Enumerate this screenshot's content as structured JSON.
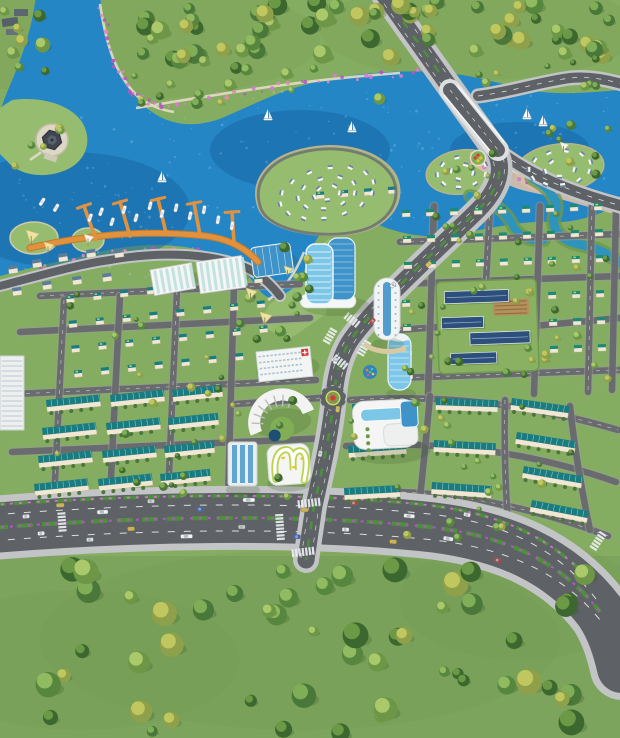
{
  "meta": {
    "title": "aerial-masterplan-render",
    "canvas_width": 620,
    "canvas_height": 738,
    "seed": 11
  },
  "palette": {
    "grass": "#85ad61",
    "grassLight": "#96bd6f",
    "grassDark": "#6e9750",
    "field": "#7ca45d",
    "water": "#2586c6",
    "waterDeep": "#1868a6",
    "canal": "#2f94bb",
    "sparkle": "#cfeaf8",
    "road": "#5e6165",
    "roadMinor": "#696b6f",
    "sidewalk": "#c2c4c5",
    "lane": "#f2f3ee",
    "path": "#e4ddc6",
    "sand": "#dcc0a8",
    "dock": "#e0923e",
    "dockDark": "#c47a2c",
    "roofTeal": "#187c80",
    "roofTeal2": "#1d8a74",
    "roofSlate": "#5d7c9a",
    "roofBlue": "#2c4f7c",
    "lime": "#cadd66",
    "wall": "#f0e8d4",
    "white": "#f5f6f6",
    "glass": "#7cc6e8",
    "glassDark": "#3f93c9",
    "red": "#d63b33",
    "yellow": "#e9c234",
    "sailYellow": "#f0e6a0",
    "sailWhite": "#f8f8f3",
    "flower1": "#b459c0",
    "flower2": "#d77ad2",
    "flower3": "#e08bb0",
    "treePairs": [
      [
        "#3c682f",
        "#6f9c48"
      ],
      [
        "#4a773a",
        "#83b159"
      ],
      [
        "#57863f",
        "#94be63"
      ],
      [
        "#6d9747",
        "#aecb6d"
      ],
      [
        "#8fa04b",
        "#c3c95f"
      ]
    ]
  },
  "water": {
    "main_d": "M36,-4 C30,42 16,70 4,100 L0,112 L0,276 C30,268 54,262 84,256 C118,246 156,241 196,249 C224,255 244,266 258,289 C272,305 287,302 300,281 C308,264 310,250 318,237 C330,217 350,212 372,222 C398,234 428,240 458,234 C492,228 520,221 548,222 C576,224 600,214 622,204 L622,90 C590,92 560,96 530,90 C500,84 470,74 436,72 C396,70 350,73 308,84 C274,93 246,108 222,118 C196,128 172,126 152,112 C128,95 112,62 104,28 L100,-4 Z",
    "deep_spots": [
      [
        70,
        210,
        120,
        58
      ],
      [
        300,
        150,
        90,
        40
      ],
      [
        520,
        150,
        70,
        28
      ]
    ],
    "sparkle_regions": [
      [
        6,
        100,
        220,
        180,
        80
      ],
      [
        240,
        90,
        200,
        140,
        60
      ],
      [
        450,
        92,
        165,
        100,
        45
      ]
    ],
    "canals": [
      {
        "d": "M532,178 C548,186 560,200 555,214 C550,228 560,240 578,244 C598,248 612,256 622,264",
        "w": 9
      },
      {
        "d": "M470,196 C490,200 505,210 512,224 C518,236 530,242 544,240",
        "w": 8
      }
    ]
  },
  "islands": {
    "teardrop": {
      "d": "M258,206 C250,180 268,158 300,150 C340,140 382,150 396,176 C404,194 398,214 376,226 C344,243 266,236 258,206 Z",
      "ring": {
        "cx": 327,
        "cy": 193,
        "rx": 58,
        "ry": 30,
        "rot": -12,
        "rings": [
          [
            0.97,
            14
          ],
          [
            0.6,
            9
          ],
          [
            0.28,
            5
          ]
        ]
      }
    },
    "islets": [
      {
        "cx": 462,
        "cy": 172,
        "rx": 36,
        "ry": 22,
        "rot": -8,
        "rings": [
          [
            0.82,
            9
          ],
          [
            0.4,
            4
          ]
        ]
      },
      {
        "cx": 560,
        "cy": 168,
        "rx": 44,
        "ry": 24,
        "rot": -6,
        "rings": [
          [
            0.84,
            11
          ],
          [
            0.42,
            5
          ]
        ]
      }
    ],
    "gazebo_peninsula": "M12,100 C40,96 70,104 82,122 C92,138 88,158 70,168 C48,180 20,176 8,162 L0,154 L0,108 Z",
    "beach_d": "M470,152 C510,160 540,168 560,178 C585,188 605,196 622,202 L622,216 C590,208 560,198 530,192 C505,187 485,172 470,164 Z",
    "decks": [
      [
        34,
        238,
        24,
        16
      ],
      [
        88,
        240,
        16,
        12
      ]
    ],
    "park_poly": "M270,304 L302,282 L312,252 L330,238 L326,314 L288,340 L258,324 Z"
  },
  "roads": {
    "boulevard": {
      "d": "M-8,528 C140,516 300,514 420,526 C505,534 562,562 600,612 C612,630 618,650 622,668",
      "sw": 64,
      "w": 50
    },
    "boulevard_dashes": [
      "M-8,515 C140,503 300,501 420,513 C505,521 558,549 596,599",
      "M-8,541 C140,529 300,527 424,539 C509,547 566,575 604,625"
    ],
    "boulevard_median": "M-8,528 C140,516 300,514 420,526 C505,534 562,562 600,612",
    "boulevard_north_strip": "M-8,505 C140,494 300,492 418,504 C498,512 548,535 592,582",
    "avenue": {
      "d": "M382,-8 L456,96 L492,146 C506,166 500,188 478,210 C448,240 380,300 352,338 C342,352 336,372 334,396 C331,432 322,470 314,506 L306,560",
      "sw": 26,
      "w": 17
    },
    "avenue_dashes": [
      "M377,-6 L451,98 L487,148 C501,168 495,188 473,210 C443,240 375,300 347,338 C337,352 331,372 329,396 C326,432 317,470 309,506 L301,558",
      "M387,-10 L461,94 L497,144 C511,166 505,188 483,210 C453,240 385,300 357,338 C347,352 341,372 339,396 C336,432 327,470 319,506 L311,560"
    ],
    "others": [
      {
        "name": "north-bank-road",
        "d": "M478,96 C510,92 540,82 570,78 C590,76 608,80 622,84",
        "sw": 15,
        "w": 10,
        "dash": true
      },
      {
        "name": "east-shore-road",
        "d": "M492,146 C530,176 570,192 622,206",
        "sw": 16,
        "w": 11,
        "dash": true
      },
      {
        "name": "west-shore-road",
        "d": "M0,286 C46,274 80,264 110,260 C155,252 205,252 242,266 C258,272 270,283 280,296",
        "sw": 12,
        "w": 8,
        "dash": false
      }
    ],
    "minor": [
      "M40,296 L300,284",
      "M20,332 L310,318",
      "M16,394 L316,380",
      "M12,452 L330,438",
      "M64,300 L54,500",
      "M120,296 L110,498",
      "M177,291 L168,497",
      "M234,287 L228,497",
      "M400,242 L620,234",
      "M398,284 L620,276",
      "M398,330 L440,327",
      "M534,326 L620,318",
      "M396,378 L620,370",
      "M434,206 L428,394",
      "M490,206 L486,282",
      "M540,206 L534,394",
      "M592,206 L588,392",
      "M616,208 L612,390",
      "M350,400 C440,394 530,404 618,430",
      "M346,446 C440,440 532,452 616,482",
      "M342,492 C430,488 520,502 608,536",
      "M430,396 C426,440 422,480 418,516",
      "M505,400 C504,440 505,480 508,524",
      "M570,406 C574,444 580,482 590,530",
      "M320,398 C290,400 262,402 236,404"
    ]
  },
  "bridge": {
    "deck": "M450,90 L498,150",
    "rail1": "M444,95 L491,152",
    "rail2": "M457,85 L504,142"
  },
  "zebras": [
    {
      "x": 352,
      "y": 320,
      "dir": -52,
      "n": 5
    },
    {
      "x": 340,
      "y": 362,
      "dir": -52,
      "n": 5
    },
    {
      "x": 330,
      "y": 336,
      "dir": 30,
      "n": 5
    },
    {
      "x": 364,
      "y": 348,
      "dir": 30,
      "n": 5
    },
    {
      "x": 309,
      "y": 503,
      "dir": 83,
      "n": 7
    },
    {
      "x": 303,
      "y": 552,
      "dir": 83,
      "n": 7
    },
    {
      "x": 280,
      "y": 527,
      "dir": -4,
      "n": 8
    },
    {
      "x": 598,
      "y": 541,
      "dir": 33,
      "n": 6
    },
    {
      "x": 62,
      "y": 522,
      "dir": -4,
      "n": 6
    }
  ],
  "blocks": {
    "villas": [
      {
        "x": 66,
        "y": 296,
        "rows": 4,
        "cols": 8,
        "dx": 27,
        "dy": 25,
        "rot": -6,
        "roof": "#187c80"
      },
      {
        "x": 402,
        "y": 210,
        "rows": 3,
        "cols": 9,
        "dx": 24,
        "dy": 26,
        "rot": -2,
        "roof": "#1d8a74"
      },
      {
        "x": 402,
        "y": 300,
        "rows": 4,
        "cols": 1,
        "dx": 24,
        "dy": 24,
        "rot": -2,
        "roof": "#1d8a74"
      },
      {
        "x": 548,
        "y": 292,
        "rows": 3,
        "cols": 3,
        "dx": 24,
        "dy": 27,
        "rot": -2,
        "roof": "#1d8a74"
      },
      {
        "x": 316,
        "y": 192,
        "rows": 1,
        "cols": 4,
        "dx": 24,
        "dy": 0,
        "rot": -4,
        "roof": "#187c80"
      }
    ],
    "rowhouses": [
      [
        46,
        400,
        54,
        -6
      ],
      [
        110,
        395,
        54,
        -6
      ],
      [
        172,
        390,
        50,
        -6
      ],
      [
        42,
        428,
        54,
        -6
      ],
      [
        106,
        423,
        54,
        -6
      ],
      [
        168,
        418,
        50,
        -6
      ],
      [
        38,
        456,
        54,
        -6
      ],
      [
        102,
        451,
        54,
        -6
      ],
      [
        164,
        446,
        50,
        -6
      ],
      [
        34,
        484,
        54,
        -6
      ],
      [
        98,
        479,
        54,
        -6
      ],
      [
        160,
        474,
        50,
        -6
      ],
      [
        352,
        404,
        58,
        -4
      ],
      [
        348,
        446,
        58,
        -4
      ],
      [
        344,
        488,
        56,
        -3
      ],
      [
        436,
        398,
        62,
        2
      ],
      [
        434,
        440,
        62,
        3
      ],
      [
        432,
        482,
        60,
        4
      ],
      [
        512,
        398,
        58,
        8
      ],
      [
        517,
        432,
        60,
        9
      ],
      [
        524,
        466,
        60,
        10
      ],
      [
        532,
        500,
        58,
        11
      ]
    ],
    "shore_villas": [
      [
        8,
        266
      ],
      [
        32,
        260
      ],
      [
        58,
        254
      ],
      [
        86,
        250
      ],
      [
        114,
        250
      ],
      [
        12,
        288
      ],
      [
        42,
        282
      ],
      [
        72,
        277
      ],
      [
        102,
        274
      ]
    ]
  },
  "marina": {
    "promenade": "M30,248 C90,234 150,230 206,236 C228,239 246,248 258,262",
    "piers": [
      [
        96,
        240,
        84,
        206
      ],
      [
        130,
        236,
        120,
        202
      ],
      [
        166,
        233,
        158,
        199
      ],
      [
        200,
        235,
        194,
        203
      ],
      [
        234,
        243,
        232,
        212
      ]
    ],
    "boats": [
      [
        90,
        218,
        -70
      ],
      [
        101,
        212,
        -70
      ],
      [
        112,
        222,
        -72
      ],
      [
        124,
        210,
        -74
      ],
      [
        136,
        218,
        -74
      ],
      [
        150,
        206,
        -76
      ],
      [
        162,
        214,
        -76
      ],
      [
        176,
        208,
        -78
      ],
      [
        190,
        216,
        -78
      ],
      [
        204,
        210,
        -80
      ],
      [
        218,
        220,
        -80
      ],
      [
        232,
        226,
        -82
      ],
      [
        56,
        208,
        -60
      ],
      [
        42,
        202,
        -58
      ]
    ]
  },
  "sailboats": [
    [
      162,
      180
    ],
    [
      268,
      118
    ],
    [
      352,
      130
    ],
    [
      527,
      117
    ],
    [
      543,
      124
    ]
  ],
  "canopies": [
    {
      "x": 26,
      "y": 230,
      "s": 13,
      "c": "yellow"
    },
    {
      "x": 44,
      "y": 242,
      "s": 10,
      "c": "yellow"
    },
    {
      "x": 84,
      "y": 234,
      "s": 10,
      "c": "white"
    },
    {
      "x": 246,
      "y": 288,
      "s": 11,
      "c": "yellow"
    },
    {
      "x": 260,
      "y": 312,
      "s": 12,
      "c": "yellow"
    },
    {
      "x": 284,
      "y": 266,
      "s": 9,
      "c": "yellow"
    },
    {
      "x": 560,
      "y": 142,
      "s": 9,
      "c": "white"
    }
  ],
  "market_halls": [
    [
      150,
      270,
      42,
      26,
      -10
    ],
    [
      196,
      262,
      46,
      32,
      -8
    ]
  ],
  "landmarks": {
    "gazebo": {
      "x": 52,
      "y": 140
    },
    "twin_tower": {
      "x": 306,
      "y": 238
    },
    "glass_low": {
      "x": 250,
      "y": 248,
      "w": 40,
      "h": 30,
      "rot": -8
    },
    "cylinder_tower": {
      "x": 388,
      "y": 334
    },
    "white_tower": {
      "x": 374,
      "y": 278
    },
    "slab_red_cross": {
      "x": 256,
      "y": 352,
      "w": 54,
      "h": 30,
      "rot": -6
    },
    "fan_building": {
      "x": 248,
      "y": 392
    },
    "track_building": {
      "x": 266,
      "y": 438
    },
    "office_tower2": {
      "x": 228,
      "y": 442
    },
    "mall": {
      "x": 352,
      "y": 402
    },
    "campus": {
      "x": 436,
      "y": 282,
      "w": 100,
      "h": 92,
      "rot": -2,
      "slabs": [
        [
          8,
          10,
          64,
          12
        ],
        [
          4,
          36,
          42,
          11
        ],
        [
          32,
          52,
          60,
          12
        ],
        [
          12,
          72,
          46,
          11
        ]
      ],
      "garden": [
        56,
        20,
        36,
        16
      ]
    },
    "apartment_left": {
      "x": 0,
      "y": 356
    },
    "courts": [
      [
        30,
        386,
        24,
        13
      ],
      [
        33,
        403,
        24,
        13
      ]
    ],
    "temple": {
      "x": 2,
      "y": 8
    },
    "playground": {
      "x": 370,
      "y": 372
    },
    "parterre": {
      "x": 478,
      "y": 158
    },
    "roundabout": {
      "x": 333,
      "y": 398
    }
  },
  "tree_regions": [
    {
      "x": 140,
      "y": 2,
      "w": 240,
      "h": 60,
      "count": 34,
      "rmin": 5,
      "rmax": 10
    },
    {
      "x": 390,
      "y": 2,
      "w": 228,
      "h": 56,
      "count": 30,
      "rmin": 5,
      "rmax": 10
    },
    {
      "x": 0,
      "y": 0,
      "w": 58,
      "h": 78,
      "count": 8,
      "rmin": 4,
      "rmax": 8
    },
    {
      "x": 130,
      "y": 62,
      "w": 250,
      "h": 44,
      "count": 15,
      "rmin": 3,
      "rmax": 6
    },
    {
      "x": 470,
      "y": 56,
      "w": 148,
      "h": 32,
      "count": 9,
      "rmin": 3,
      "rmax": 5
    },
    {
      "x": 0,
      "y": 566,
      "w": 618,
      "h": 168,
      "count": 52,
      "rmin": 5,
      "rmax": 13
    },
    {
      "x": 55,
      "y": 292,
      "w": 250,
      "h": 205,
      "count": 32,
      "rmin": 2.5,
      "rmax": 4.5
    },
    {
      "x": 398,
      "y": 206,
      "w": 218,
      "h": 185,
      "count": 38,
      "rmin": 2.5,
      "rmax": 4.5
    },
    {
      "x": 344,
      "y": 398,
      "w": 262,
      "h": 140,
      "count": 24,
      "rmin": 2.5,
      "rmax": 4.5
    },
    {
      "x": 240,
      "y": 246,
      "w": 85,
      "h": 92,
      "count": 11,
      "rmin": 3,
      "rmax": 5.5
    },
    {
      "x": 540,
      "y": 122,
      "w": 76,
      "h": 55,
      "count": 8,
      "rmin": 3,
      "rmax": 5
    },
    {
      "x": 432,
      "y": 150,
      "w": 80,
      "h": 48,
      "count": 6,
      "rmin": 2.5,
      "rmax": 4
    },
    {
      "x": 8,
      "y": 104,
      "w": 70,
      "h": 62,
      "count": 5,
      "rmin": 3,
      "rmax": 5
    }
  ],
  "flower_lines": [
    {
      "pts": [
        [
          101,
          8
        ],
        [
          112,
          60
        ],
        [
          130,
          92
        ],
        [
          158,
          108
        ]
      ],
      "count": 26
    },
    {
      "pts": [
        [
          160,
          106
        ],
        [
          240,
          92
        ],
        [
          330,
          78
        ],
        [
          420,
          72
        ]
      ],
      "count": 30
    },
    {
      "pts": [
        [
          0,
          284
        ],
        [
          60,
          264
        ],
        [
          120,
          252
        ],
        [
          200,
          248
        ]
      ],
      "count": 20
    },
    {
      "pts": [
        [
          470,
          160
        ],
        [
          530,
          180
        ],
        [
          580,
          195
        ],
        [
          618,
          205
        ]
      ],
      "count": 16
    }
  ],
  "park_paths": [
    "M100,4 C106,44 116,78 140,98 C150,106 162,110 174,112",
    "M136,108 C220,94 300,80 400,73",
    "M30,160 C44,150 52,146 62,134",
    "M268,300 C284,290 296,272 304,252",
    "M480,160 C510,170 545,182 580,192"
  ],
  "vehicles": {
    "boulevard": [
      [
        0.05,
        -9,
        "#e8e8e8",
        7
      ],
      [
        0.1,
        -18,
        "#e3b421",
        8
      ],
      [
        0.16,
        -9,
        "#f2f2f2",
        11
      ],
      [
        0.23,
        -18,
        "#d0d2d4",
        7
      ],
      [
        0.3,
        -9,
        "#3a62c4",
        7
      ],
      [
        0.37,
        -18,
        "#f4f4f4",
        12
      ],
      [
        0.45,
        -9,
        "#e3b421",
        7
      ],
      [
        0.52,
        -18,
        "#c23a32",
        7
      ],
      [
        0.6,
        -9,
        "#f0f0f0",
        11
      ],
      [
        0.68,
        -18,
        "#e8e8e8",
        7
      ],
      [
        0.07,
        9,
        "#f0f0f0",
        7
      ],
      [
        0.14,
        18,
        "#dddddd",
        7
      ],
      [
        0.2,
        9,
        "#e3b421",
        7
      ],
      [
        0.28,
        18,
        "#f4f4f4",
        12
      ],
      [
        0.36,
        9,
        "#c8cacb",
        7
      ],
      [
        0.44,
        18,
        "#3a62c4",
        7
      ],
      [
        0.51,
        9,
        "#f2f2f2",
        7
      ],
      [
        0.58,
        18,
        "#e3b421",
        7
      ],
      [
        0.66,
        9,
        "#eeeeee",
        10
      ],
      [
        0.74,
        18,
        "#c23a32",
        7
      ]
    ],
    "avenue": [
      [
        0.5,
        -5,
        "#e9c234",
        6
      ],
      [
        0.56,
        5,
        "#eeeeee",
        6
      ],
      [
        0.62,
        -5,
        "#d63b33",
        6
      ],
      [
        0.7,
        5,
        "#f6f6f6",
        6
      ],
      [
        0.77,
        -5,
        "#e9c234",
        6
      ],
      [
        0.84,
        5,
        "#dddddd",
        6
      ]
    ]
  }
}
